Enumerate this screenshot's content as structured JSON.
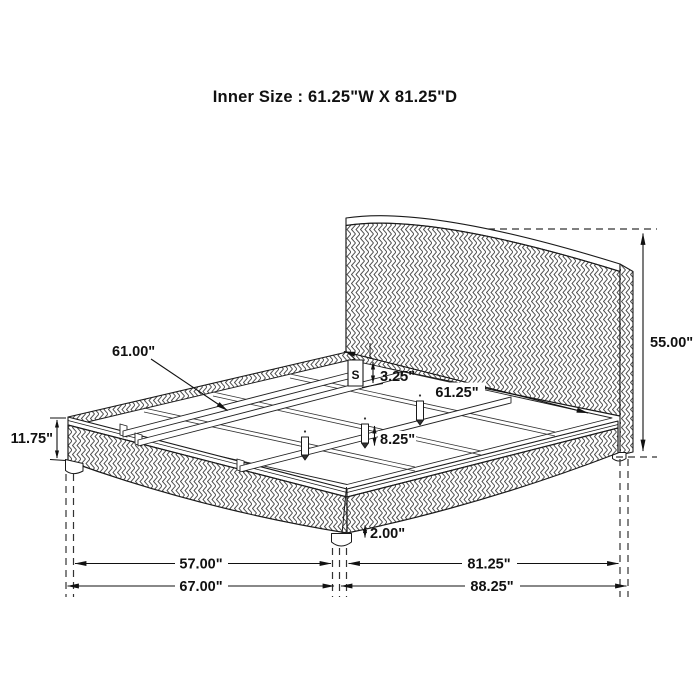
{
  "title": "Inner Size : 61.25\"W X 81.25\"D",
  "dimensions": {
    "slat_length": "61.00\"",
    "ledge_height": "3.25\"",
    "inner_width": "61.25\"",
    "headboard_height": "55.00\"",
    "side_rail_height": "11.75\"",
    "center_leg_height": "8.25\"",
    "foot_leg_height": "2.00\"",
    "front_inner_width": "57.00\"",
    "overall_width": "67.00\"",
    "inner_depth": "81.25\"",
    "overall_depth": "88.25\""
  },
  "bracket_label": "S",
  "colors": {
    "line": "#1a1a1a",
    "texture": "#4d4d4d",
    "background": "#ffffff"
  }
}
